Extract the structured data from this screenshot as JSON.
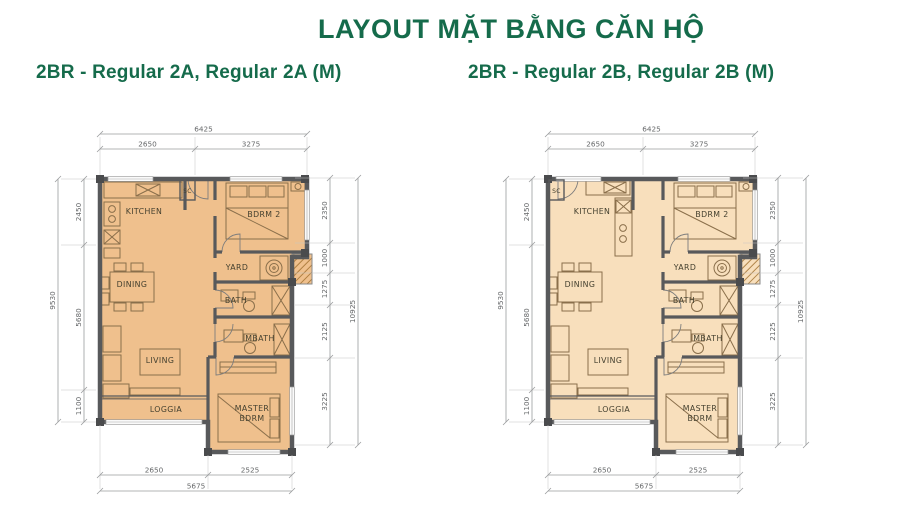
{
  "page": {
    "title": "LAYOUT MẶT BẰNG CĂN HỘ"
  },
  "colors": {
    "title": "#156B4B",
    "subtitle": "#156B4B",
    "wall": "#58595B",
    "column": "#4A4B4D",
    "dim_line": "#9A9C9E",
    "dim_text": "#66686A",
    "room_text": "#44402F",
    "furniture": "#8A6F4B",
    "hatch_line": "#A0702F",
    "plan_a_fill": "#EFC08D",
    "plan_b_fill": "#F8DFBC"
  },
  "plans": [
    {
      "id": "regular-2a",
      "subtitle": "2BR - Regular 2A, Regular 2A (M)",
      "fill": "#EFC08D",
      "kitchen_variant": "A",
      "rooms": {
        "kitchen": "KITCHEN",
        "bdrm2": "BDRM 2",
        "yard": "YARD",
        "bath": "BATH",
        "dining": "DINING",
        "mbath": "MBATH",
        "living": "LIVING",
        "loggia": "LOGGIA",
        "master_line1": "MASTER",
        "master_line2": "BDRM",
        "sc": "SC"
      },
      "dimensions": {
        "top": {
          "total": "6425",
          "segments": [
            "2650",
            "3275"
          ]
        },
        "bottom": {
          "total": "5675",
          "segments": [
            "2650",
            "2525"
          ]
        },
        "left": {
          "total": "9530",
          "segments": [
            "2450",
            "5680",
            "1100"
          ]
        },
        "right": {
          "total": "10925",
          "segments": [
            "2350",
            "1000",
            "1275",
            "2125",
            "3225"
          ]
        }
      }
    },
    {
      "id": "regular-2b",
      "subtitle": "2BR - Regular 2B, Regular 2B (M)",
      "fill": "#F8DFBC",
      "kitchen_variant": "B",
      "rooms": {
        "kitchen": "KITCHEN",
        "bdrm2": "BDRM 2",
        "yard": "YARD",
        "bath": "BATH",
        "dining": "DINING",
        "mbath": "MBATH",
        "living": "LIVING",
        "loggia": "LOGGIA",
        "master_line1": "MASTER",
        "master_line2": "BDRM",
        "sc": "SC"
      },
      "dimensions": {
        "top": {
          "total": "6425",
          "segments": [
            "2650",
            "3275"
          ]
        },
        "bottom": {
          "total": "5675",
          "segments": [
            "2650",
            "2525"
          ]
        },
        "left": {
          "total": "9530",
          "segments": [
            "2450",
            "5680",
            "1100"
          ]
        },
        "right": {
          "total": "10925",
          "segments": [
            "2350",
            "1000",
            "1275",
            "2125",
            "3225"
          ]
        }
      }
    }
  ]
}
